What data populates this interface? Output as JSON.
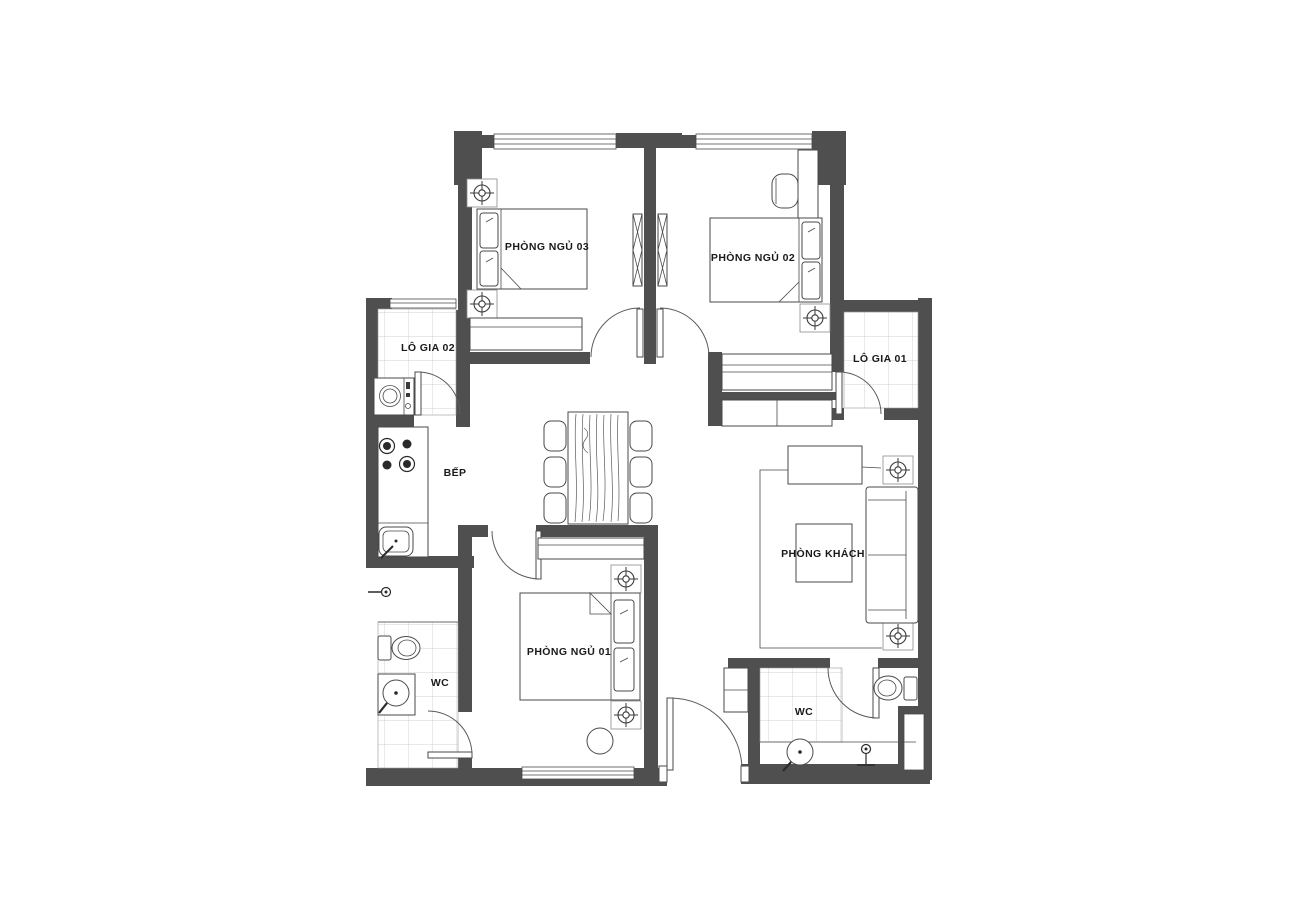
{
  "plan": {
    "type": "apartment floor plan",
    "rooms": [
      {
        "id": "bedroom-03",
        "label": "PHÒNG NGỦ 03"
      },
      {
        "id": "bedroom-02",
        "label": "PHÒNG NGỦ 02"
      },
      {
        "id": "loggia-02",
        "label": "LÔ GIA 02"
      },
      {
        "id": "loggia-01",
        "label": "LÔ GIA 01"
      },
      {
        "id": "kitchen",
        "label": "BẾP"
      },
      {
        "id": "living-room",
        "label": "PHÒNG KHÁCH"
      },
      {
        "id": "bedroom-01",
        "label": "PHÒNG NGỦ 01"
      },
      {
        "id": "wc-left",
        "label": "WC"
      },
      {
        "id": "wc-right",
        "label": "WC"
      }
    ],
    "colors": {
      "background": "#ffffff",
      "wall": "#4f4f4f",
      "furniture_line": "#4a4a4a",
      "tile_line": "#c4c4c4",
      "label_text": "#1a1a1a"
    },
    "icons": [
      "ceiling-light-icon",
      "washing-machine-icon",
      "stove-icon",
      "kitchen-sink-icon",
      "toilet-icon",
      "basin-icon",
      "shower-icon",
      "double-bed-icon",
      "sofa-icon",
      "dining-table-icon",
      "wardrobe-icon",
      "door-swing-icon",
      "window-icon"
    ]
  }
}
